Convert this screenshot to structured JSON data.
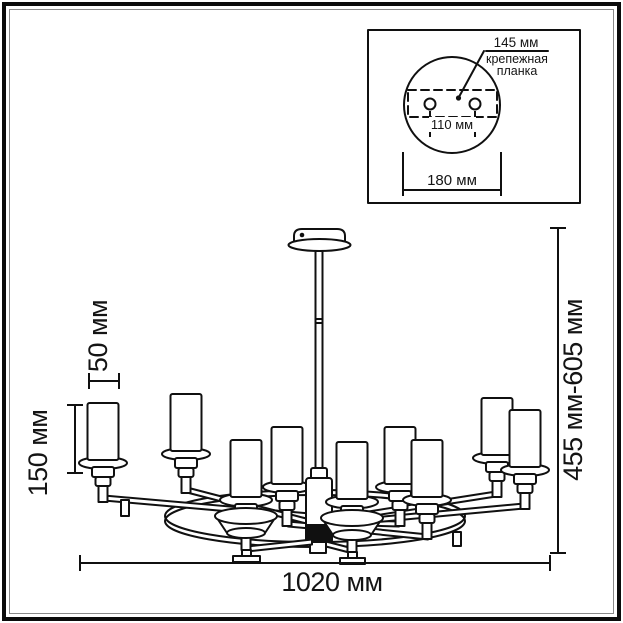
{
  "drawing": {
    "kind": "chandelier installation dimension drawing",
    "line_color": "#101010",
    "background": "#ffffff"
  },
  "inset": {
    "plate_offset_label": "145 мм",
    "plate_name_line1": "крепежная",
    "plate_name_line2": "планка",
    "holes_distance_label": "110 мм",
    "canopy_diameter_label": "180 мм"
  },
  "main_dimensions": {
    "total_width_label": "1020 мм",
    "hanging_height_label": "455 мм-605 мм",
    "shade_height_label": "150 мм",
    "shade_diameter_label": "50 мм"
  }
}
